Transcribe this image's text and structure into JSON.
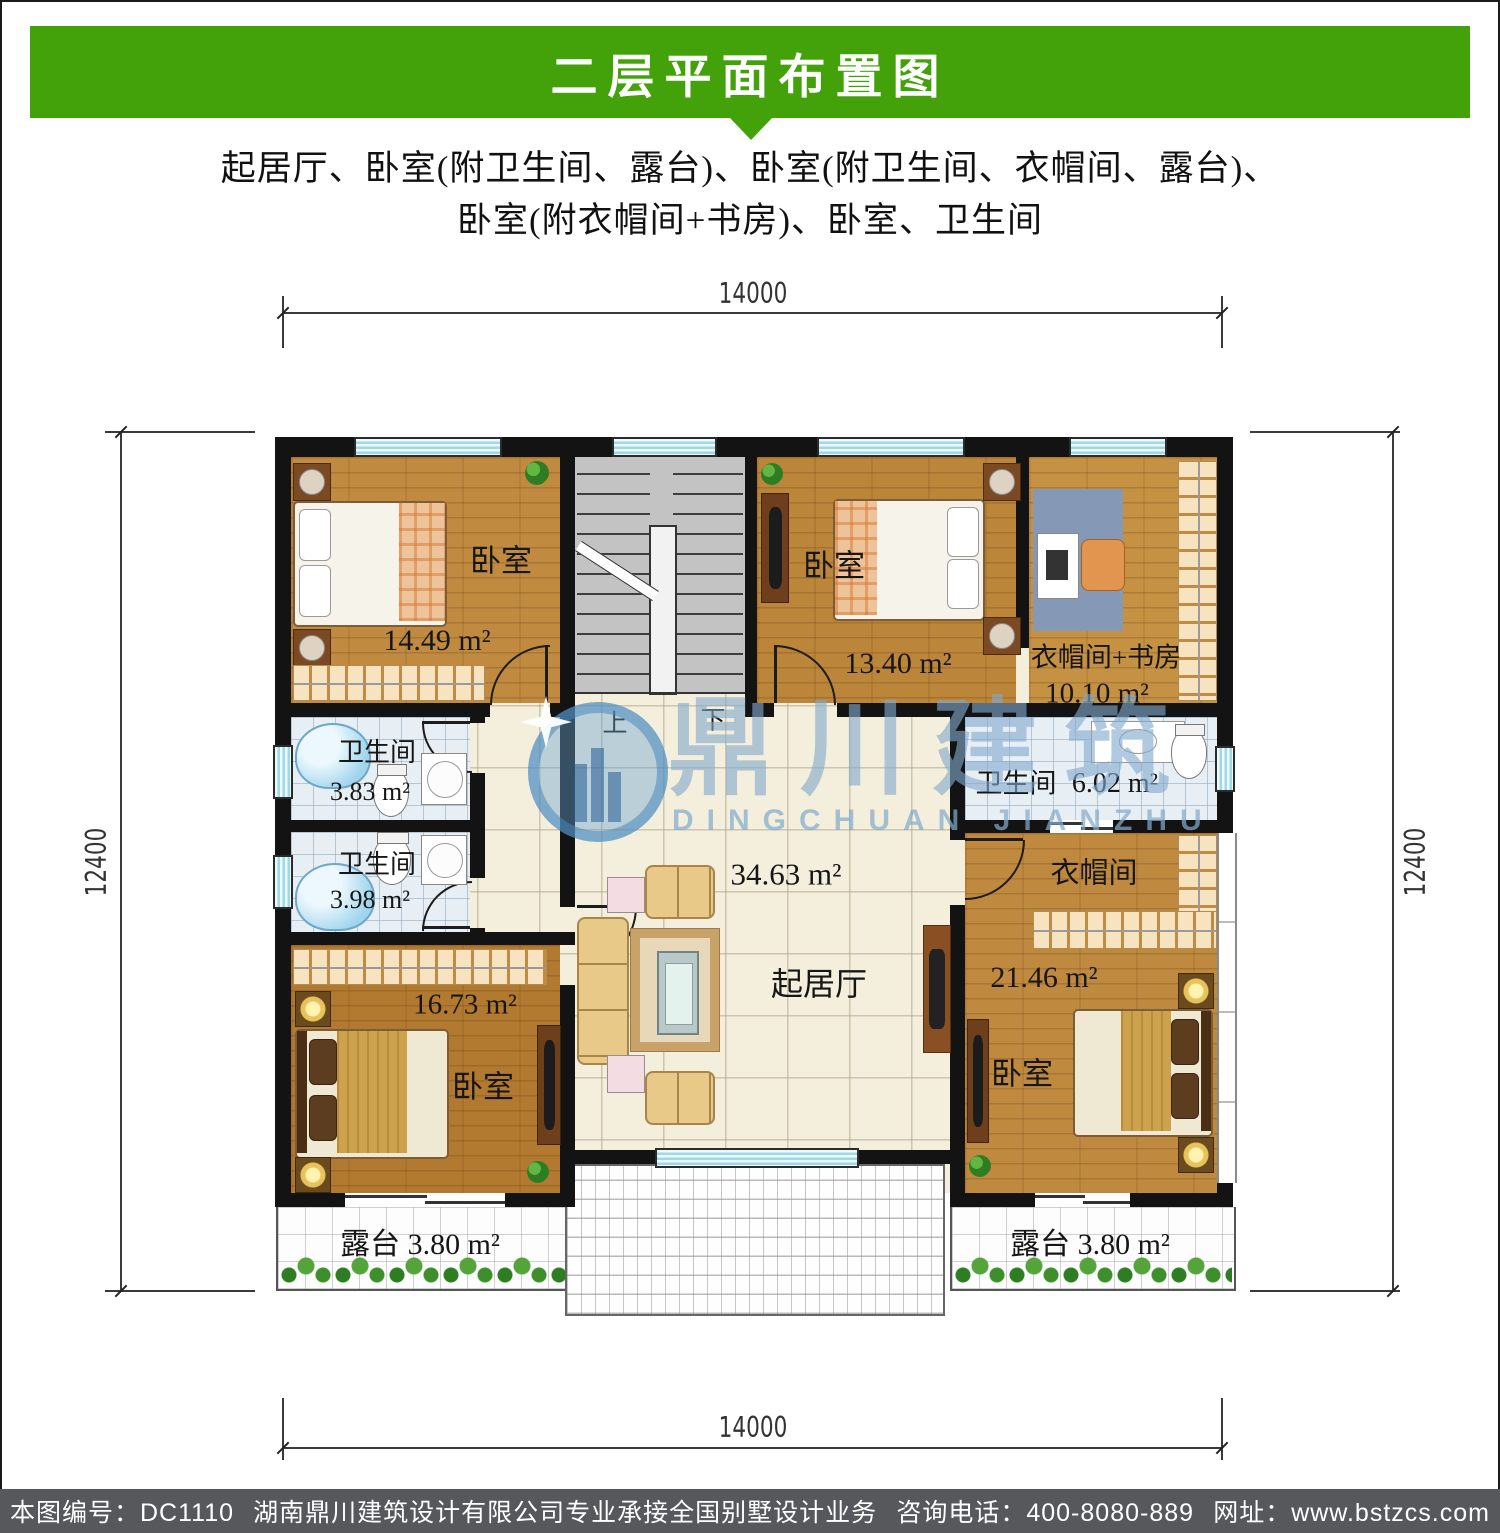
{
  "header": {
    "title": "二层平面布置图"
  },
  "subtitle": {
    "line1": "起居厅、卧室(附卫生间、露台)、卧室(附卫生间、衣帽间、露台)、",
    "line2": "卧室(附衣帽间+书房)、卧室、卫生间"
  },
  "dimensions": {
    "top": "14000",
    "bottom": "14000",
    "left": "12400",
    "right": "12400"
  },
  "stairs": {
    "up": "上",
    "down": "下"
  },
  "rooms": {
    "bedroom_nw": {
      "label": "卧室",
      "area": "14.49 m²"
    },
    "bedroom_n": {
      "label": "卧室",
      "area": "13.40 m²"
    },
    "cloak_study": {
      "label": "衣帽间+书房",
      "area": "10.10 m²"
    },
    "bath_w1": {
      "label": "卫生间",
      "area": "3.83 m²"
    },
    "bath_w2": {
      "label": "卫生间",
      "area": "3.98 m²"
    },
    "bath_e": {
      "label": "卫生间",
      "area": "6.02 m²"
    },
    "living": {
      "label": "起居厅",
      "area": "34.63 m²"
    },
    "bedroom_sw": {
      "label": "卧室",
      "area": "16.73 m²"
    },
    "bedroom_se": {
      "label": "卧室",
      "area": "21.46 m²",
      "cloak": "衣帽间"
    },
    "terrace_w": {
      "label": "露台 3.80 m²"
    },
    "terrace_e": {
      "label": "露台 3.80 m²"
    }
  },
  "watermark": {
    "cn": "鼎川建筑",
    "en": "DINGCHUAN JIANZHU"
  },
  "footer": {
    "plan_no": "本图编号：DC1110",
    "company": "湖南鼎川建筑设计有限公司专业承接全国别墅设计业务",
    "phone": "咨询电话：400-8080-889",
    "website": "网址：www.bstzcs.com"
  },
  "colors": {
    "banner_green": "#43a10a",
    "footer_gray": "#57585b",
    "wall_black": "#131313",
    "watermark_blue": "#84aacd"
  }
}
